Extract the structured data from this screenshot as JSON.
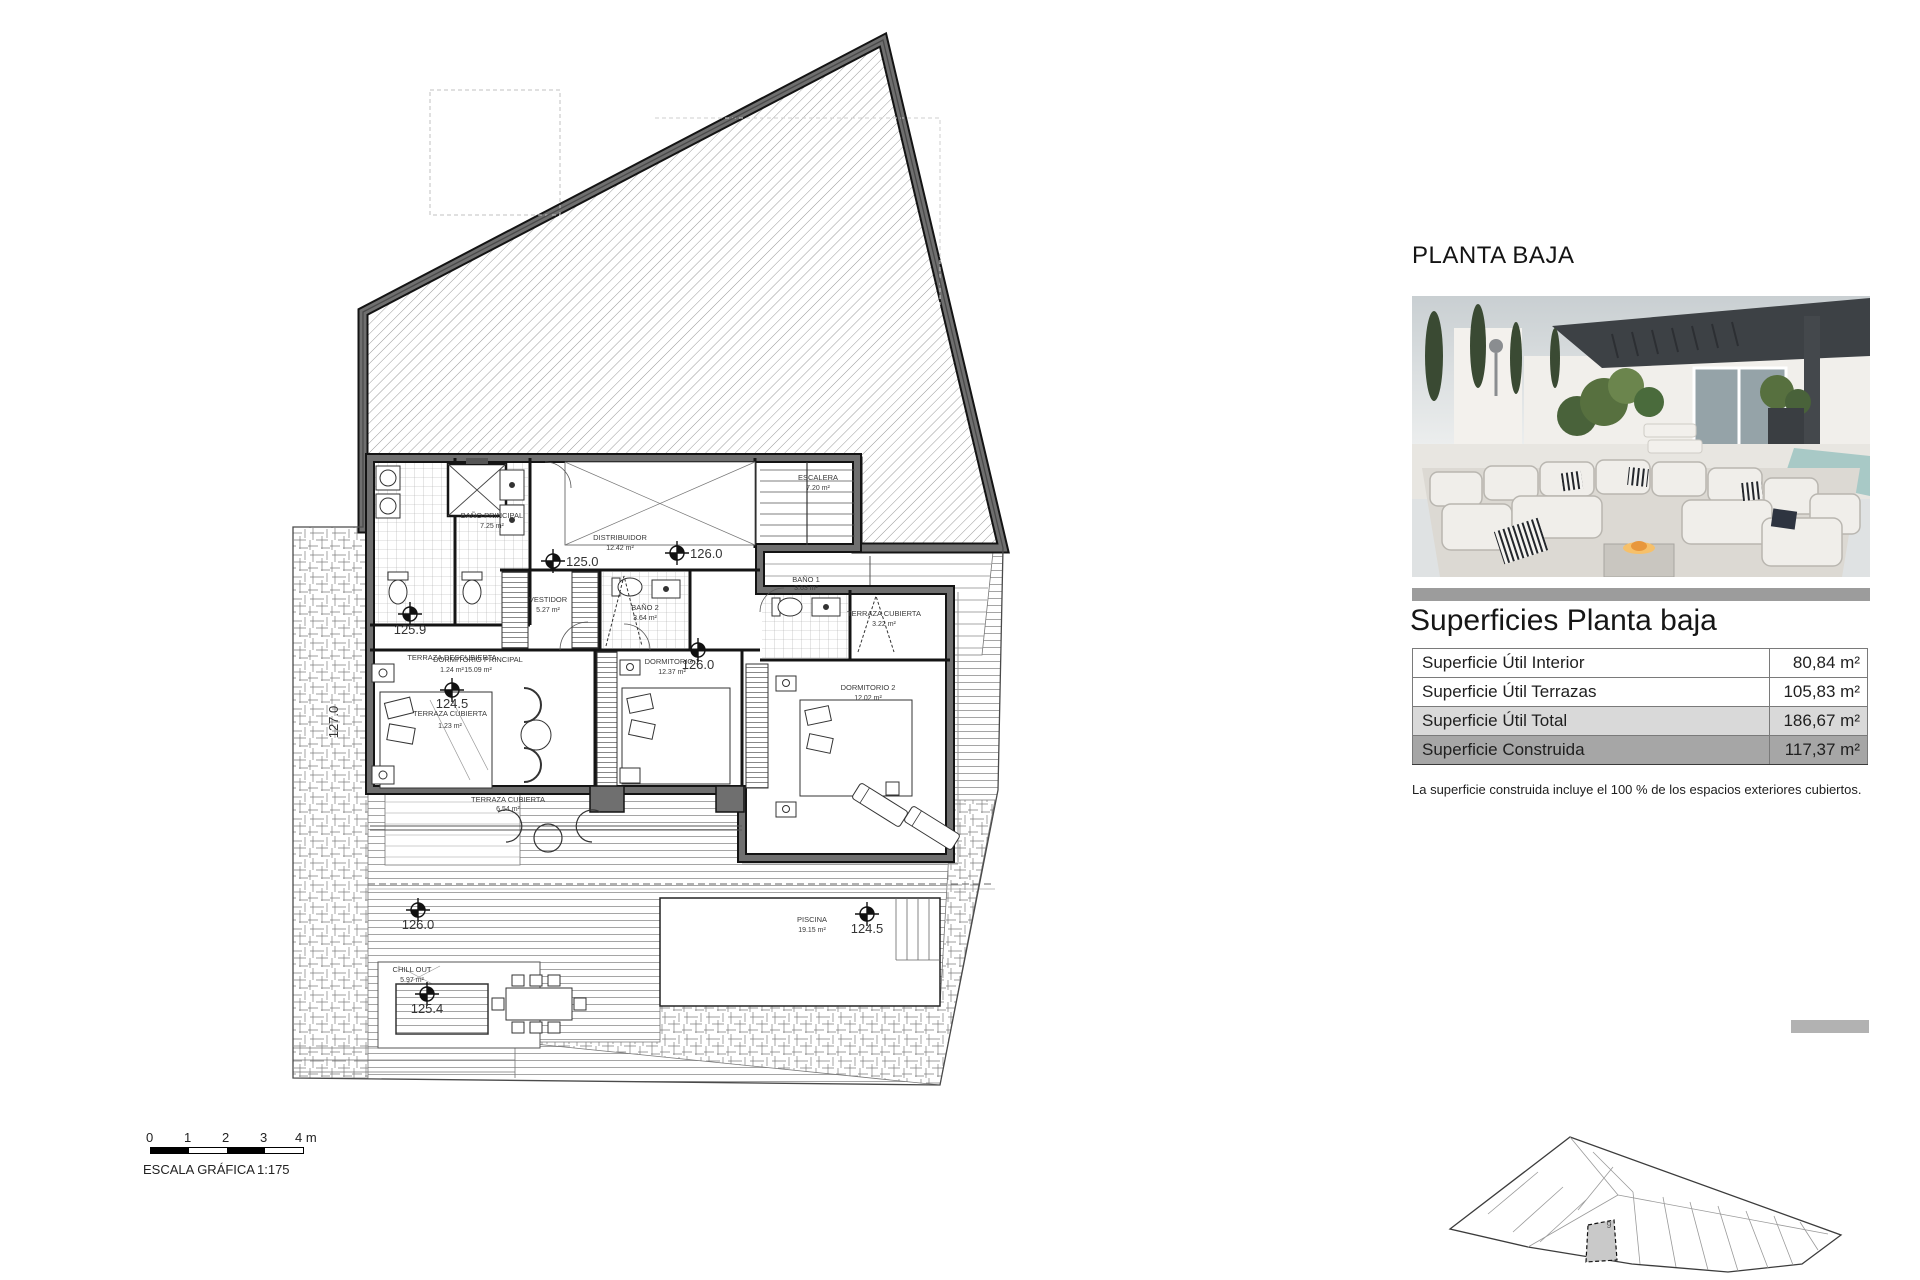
{
  "right_panel": {
    "title": "PLANTA BAJA",
    "surfaces_heading": "Superficies Planta baja",
    "table": {
      "rows": [
        {
          "label": "Superficie Útil Interior",
          "value": "80,84 m²"
        },
        {
          "label": "Superficie Útil Terrazas",
          "value": "105,83 m²"
        },
        {
          "label": "Superficie Útil Total",
          "value": "186,67 m²"
        },
        {
          "label": "Superficie Construida",
          "value": "117,37 m²"
        }
      ]
    },
    "footnote": "La superficie construida incluye el 100 % de los espacios exteriores cubiertos."
  },
  "scale_bar": {
    "ticks": [
      "0",
      "1",
      "2",
      "3"
    ],
    "end_label": "4 m",
    "caption": "ESCALA GRÁFICA",
    "ratio": "1:175"
  },
  "floor_plan": {
    "rooms": [
      {
        "name": "BAÑO PRINCIPAL",
        "area": "7.25 m²"
      },
      {
        "name": "DISTRIBUIDOR",
        "area": "12.42 m²"
      },
      {
        "name": "ESCALERA",
        "area": "7.20 m²"
      },
      {
        "name": "VESTIDOR",
        "area": "5.27 m²"
      },
      {
        "name": "BAÑO 2",
        "area": "3.64 m²"
      },
      {
        "name": "DORMITORIO PRINCIPAL",
        "area": "15.09 m²"
      },
      {
        "name": "DORMITORIO 1",
        "area": "12.37 m²"
      },
      {
        "name": "BAÑO 1",
        "area": "3.63 m²"
      },
      {
        "name": "DORMITORIO 2",
        "area": "12.02 m²"
      },
      {
        "name": "TERRAZA CUBIERTA",
        "area": "6.54 m²"
      },
      {
        "name": "TERRAZA CUBIERTA",
        "area": "3.22 m²"
      },
      {
        "name": "TERRAZA DESCUBIERTA",
        "area": "1.24 m²"
      },
      {
        "name": "TERRAZA CUBIERTA",
        "area": "1.23 m²"
      },
      {
        "name": "CHILL OUT",
        "area": "5.97 m²"
      },
      {
        "name": "PISCINA",
        "area": "19.15 m²"
      }
    ],
    "levels": [
      "125.0",
      "126.0",
      "125.9",
      "124.5",
      "126.0",
      "126.0",
      "125.4",
      "124.5",
      "127.0"
    ]
  },
  "site_plan": {
    "highlighted_plot": "9"
  },
  "colors": {
    "shade-light": "#d9d9d9",
    "shade-dark": "#a6a6a6",
    "wall-gray": "#6f6f6f",
    "plot-highlight": "#c9c9c9"
  }
}
